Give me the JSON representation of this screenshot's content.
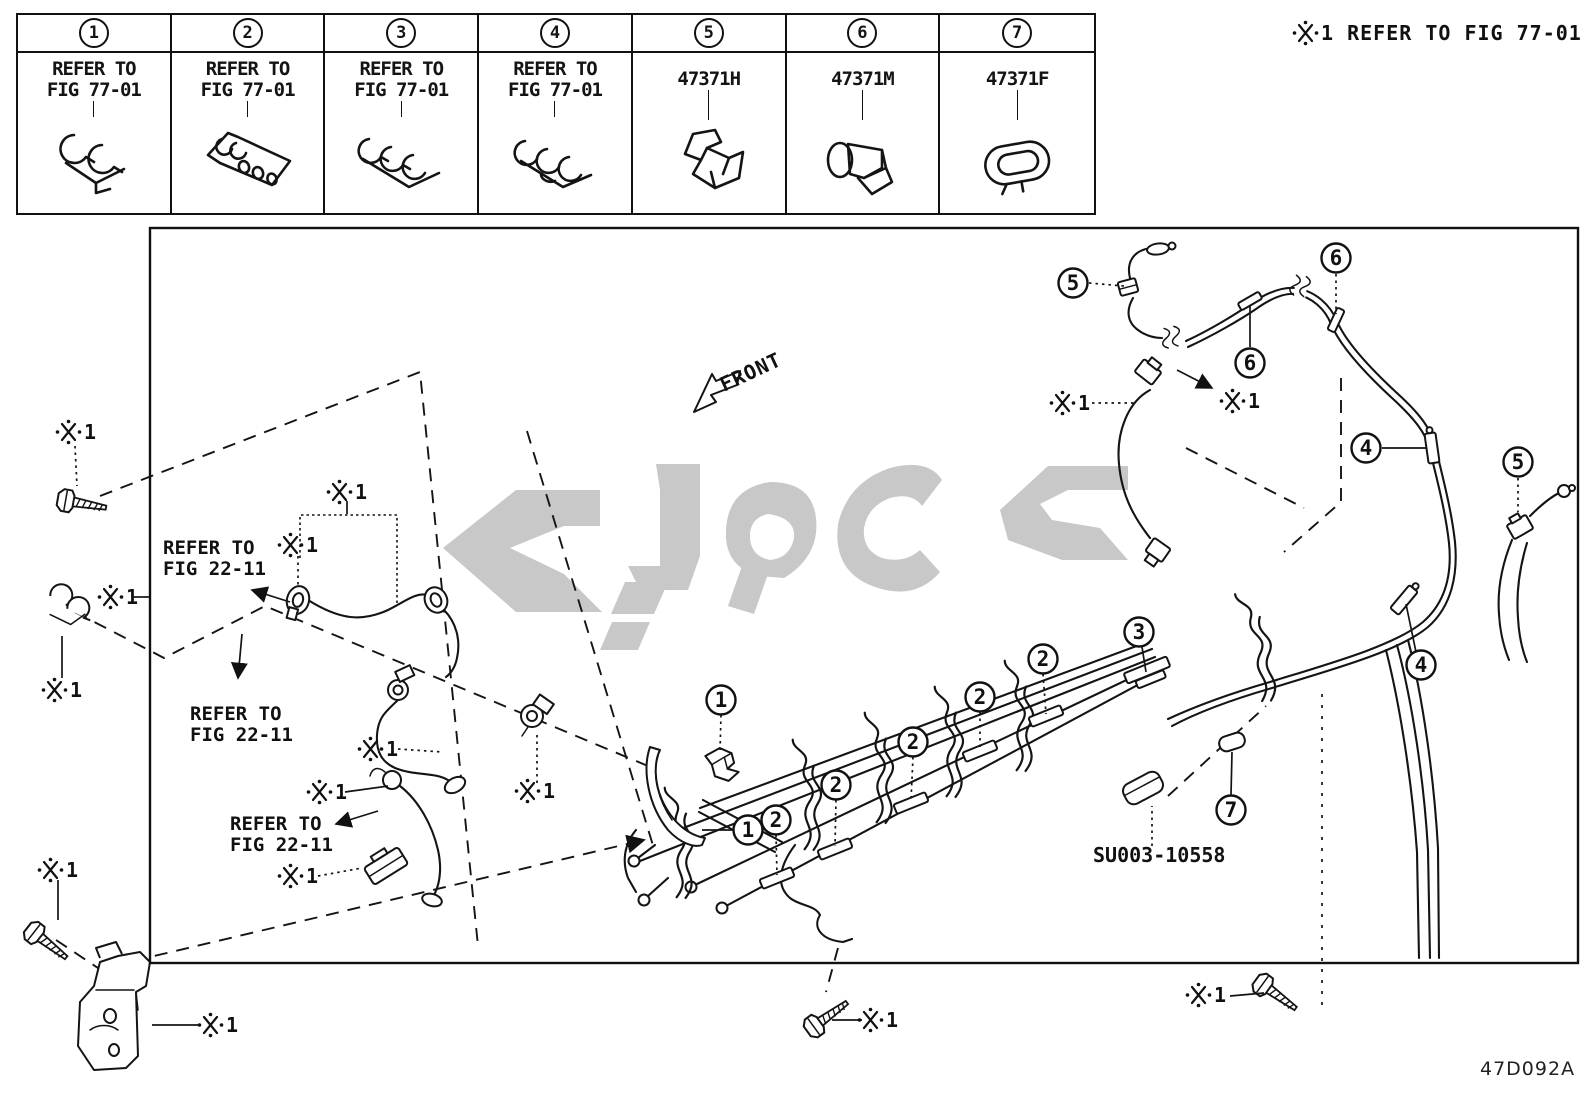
{
  "note_top_right": "※1 REFER TO FIG 77-01",
  "drawing_code": "47D092A",
  "legend": {
    "cells": [
      {
        "num": "1",
        "label_lines": [
          "REFER TO",
          "FIG 77-01"
        ],
        "icon": "clip-2way"
      },
      {
        "num": "2",
        "label_lines": [
          "REFER TO",
          "FIG 77-01"
        ],
        "icon": "bracket-multi"
      },
      {
        "num": "3",
        "label_lines": [
          "REFER TO",
          "FIG 77-01"
        ],
        "icon": "clip-3way"
      },
      {
        "num": "4",
        "label_lines": [
          "REFER TO",
          "FIG 77-01"
        ],
        "icon": "clip-3way-b"
      },
      {
        "num": "5",
        "label_lines": [
          "47371H"
        ],
        "icon": "clamp-h"
      },
      {
        "num": "6",
        "label_lines": [
          "47371M"
        ],
        "icon": "push-clip"
      },
      {
        "num": "7",
        "label_lines": [
          "47371F"
        ],
        "icon": "grommet"
      }
    ]
  },
  "diagram": {
    "front_label": "FRONT",
    "part_code": "SU003-10558",
    "asterisk": "※1",
    "refer_note_lines": [
      "REFER TO",
      "FIG 22-11"
    ],
    "ref_notes": [
      {
        "lines": [
          "REFER TO",
          "FIG 22-11"
        ],
        "x": 163,
        "y": 554
      },
      {
        "lines": [
          "REFER TO",
          "FIG 22-11"
        ],
        "x": 190,
        "y": 720
      },
      {
        "lines": [
          "REFER TO",
          "FIG 22-11"
        ],
        "x": 230,
        "y": 830
      }
    ],
    "asterisk_markers": [
      {
        "x": 62,
        "y": 432
      },
      {
        "x": 104,
        "y": 597
      },
      {
        "x": 48,
        "y": 690
      },
      {
        "x": 333,
        "y": 492
      },
      {
        "x": 284,
        "y": 545
      },
      {
        "x": 364,
        "y": 749
      },
      {
        "x": 313,
        "y": 792
      },
      {
        "x": 284,
        "y": 876
      },
      {
        "x": 44,
        "y": 870
      },
      {
        "x": 204,
        "y": 1025
      },
      {
        "x": 521,
        "y": 791
      },
      {
        "x": 1056,
        "y": 403
      },
      {
        "x": 1226,
        "y": 401
      },
      {
        "x": 1192,
        "y": 995
      },
      {
        "x": 864,
        "y": 1020
      }
    ],
    "callouts": [
      {
        "n": "5",
        "x": 1073,
        "y": 283
      },
      {
        "n": "6",
        "x": 1336,
        "y": 258
      },
      {
        "n": "6",
        "x": 1250,
        "y": 363
      },
      {
        "n": "4",
        "x": 1366,
        "y": 448
      },
      {
        "n": "5",
        "x": 1518,
        "y": 462
      },
      {
        "n": "4",
        "x": 1421,
        "y": 665
      },
      {
        "n": "3",
        "x": 1139,
        "y": 632
      },
      {
        "n": "2",
        "x": 1043,
        "y": 659
      },
      {
        "n": "2",
        "x": 980,
        "y": 697
      },
      {
        "n": "2",
        "x": 913,
        "y": 742
      },
      {
        "n": "2",
        "x": 836,
        "y": 785
      },
      {
        "n": "2",
        "x": 776,
        "y": 820
      },
      {
        "n": "1",
        "x": 721,
        "y": 700
      },
      {
        "n": "1",
        "x": 748,
        "y": 830
      },
      {
        "n": "7",
        "x": 1231,
        "y": 810
      }
    ]
  }
}
